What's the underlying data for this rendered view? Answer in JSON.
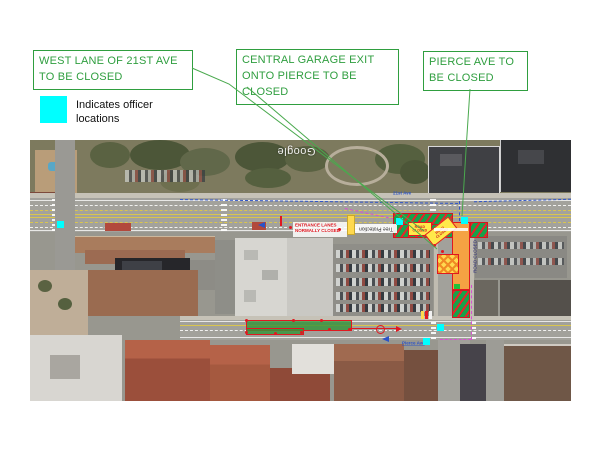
{
  "callouts": [
    {
      "id": "west-lane",
      "text": "WEST LANE OF 21ST AVE TO BE CLOSED"
    },
    {
      "id": "central-garage",
      "text": "CENTRAL GARAGE EXIT ONTO PIERCE TO BE CLOSED"
    },
    {
      "id": "pierce-ave",
      "text": "PIERCE AVE TO BE CLOSED"
    }
  ],
  "legend": {
    "swatch_color": "#00ffff",
    "label": "Indicates officer locations"
  },
  "map": {
    "watermark": "Google",
    "labels": {
      "entrance_note_line1": "ENTRANCE LANES",
      "entrance_note_line2": "NORMALLY CLOSED",
      "tree_protection": "Tree Protection",
      "pierce_bar": "ROAD CLOSED",
      "sign_line1": "ROAD",
      "sign_line2": "CLOSED",
      "blue_label_top": "21st Ave",
      "blue_label_bottom": "Pierce Ave"
    },
    "officers": {
      "color": "#00ffff",
      "positions": [
        [
          27,
          81
        ],
        [
          366,
          78
        ],
        [
          431,
          77
        ],
        [
          407,
          184
        ],
        [
          393,
          198
        ]
      ]
    },
    "colors": {
      "callout_green": "#2f9e3f",
      "closure_green": "#17a24a",
      "closure_red": "#e8232a",
      "closure_orange": "#f5a243",
      "sign_yellow": "#ffe94a"
    }
  }
}
